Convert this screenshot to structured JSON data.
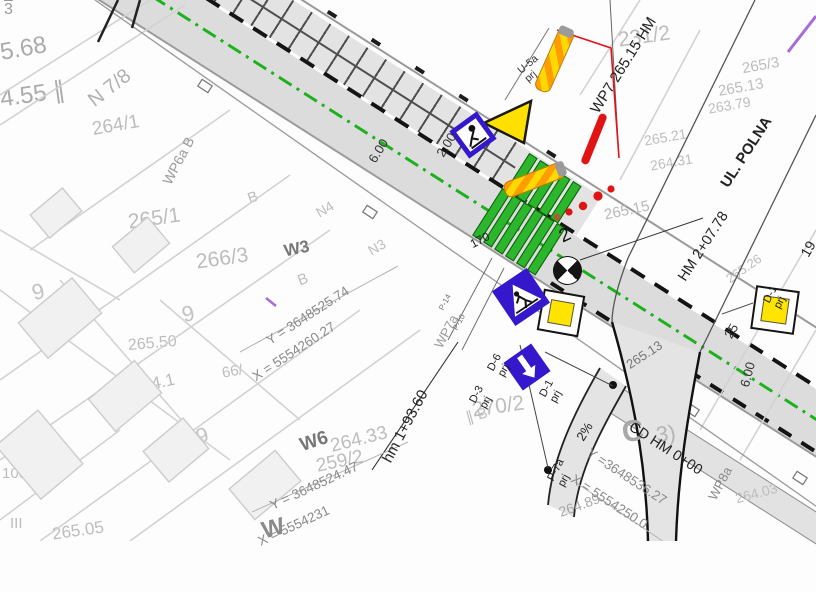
{
  "map": {
    "street": "UL. POLNA",
    "chainages": {
      "wp7": "WP7 265.15 HM",
      "hm2": "HM 2+07.78",
      "hm1": "hm 1+93.60",
      "cd": "CD HM 0+00"
    },
    "ref_points": {
      "wp6a": "WP6a  B",
      "wp7a": "WP7a",
      "wp8a": "WP8a"
    },
    "survey": {
      "w3": {
        "name": "W3",
        "y": "Y = 3648525.74",
        "x": "X = 5554260.27"
      },
      "w6": {
        "name": "W6",
        "y": "Y = 3648524.47",
        "x": "X = 5554231"
      },
      "c": {
        "name": "C",
        "y": "Y =3648536.27",
        "x": "X = 5554250.0"
      }
    },
    "sign_labels": {
      "u5a": "U-5a\nprj",
      "d6": "D-6\nprj",
      "d3": "D-3\nprj",
      "d1_left": "D-1\nprj",
      "d1_right": "D-1\nprj",
      "p7a": "P-7a\nprj"
    },
    "markings": {
      "p14": "P-14",
      "p10": "P-10"
    },
    "dims": {
      "d600a": "6.00",
      "d200": "2.00",
      "d600b": "6.00",
      "slope": "2%",
      "d25": "25",
      "d2": "2",
      "d170": "170",
      "d19": "19",
      "elev_road": "265.13"
    },
    "bg_texts": [
      "264/1",
      "231/2",
      "265/1",
      "266/3",
      "270/2",
      "259/2",
      "264.33",
      "265.50",
      "5.68",
      "4.55 ∥",
      "N 7/8",
      "64.1",
      "66/",
      "100",
      "III",
      "265.05",
      "9",
      "9",
      "9",
      "B",
      "B",
      "N4",
      "N3",
      "∥ B",
      "265.15",
      "265.13",
      "265.21",
      "264.31",
      "263.79",
      "265.26",
      "C",
      "3)",
      "264.03",
      "264.89",
      "265/3",
      "3",
      "W"
    ]
  },
  "colors": {
    "road_gray": "#dcdcdc",
    "marking_green": "#1db21d",
    "sign_blue": "#3518cc",
    "sign_yellow": "#ffe400",
    "warning_red": "#e01414",
    "pylon_orange": "#ff9d00",
    "utility_purple": "#a86bd8"
  }
}
